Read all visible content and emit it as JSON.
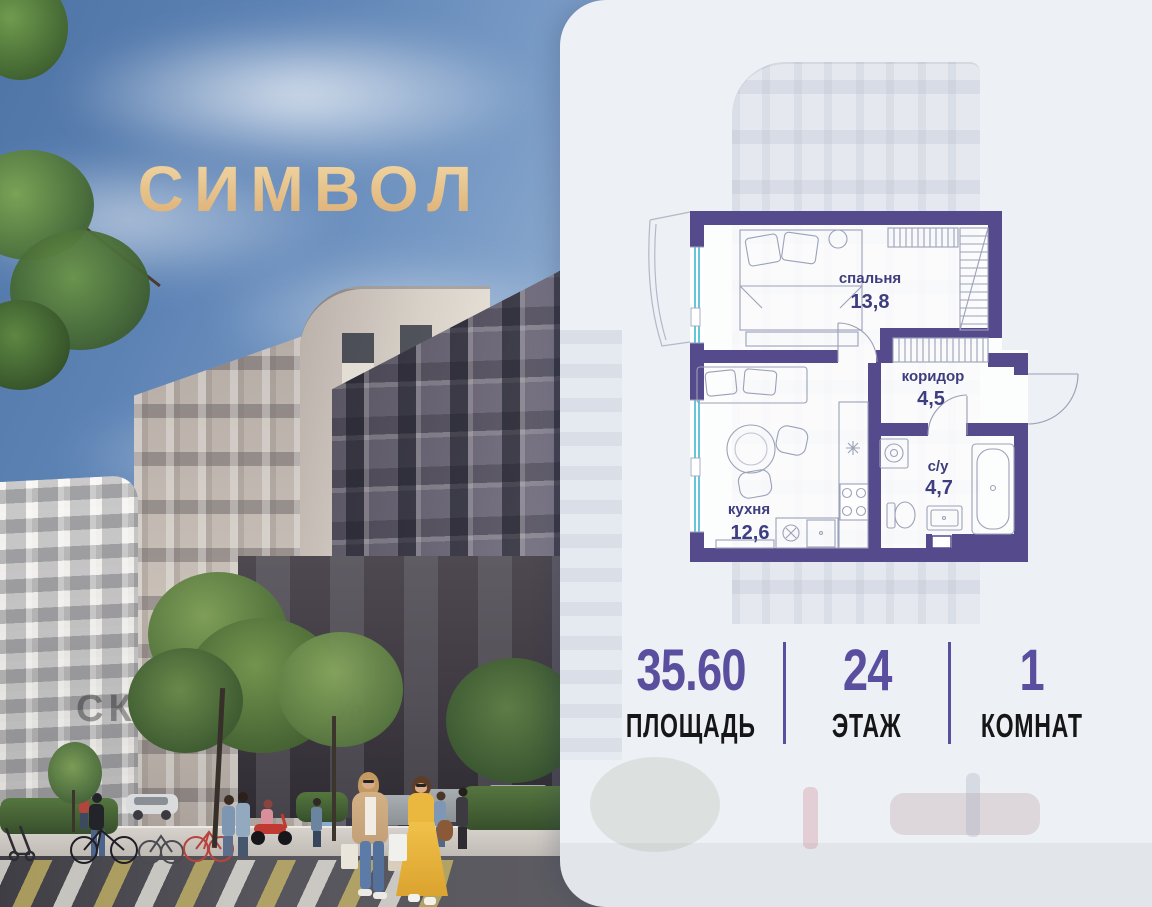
{
  "brand": {
    "logo_text": "СИМВОЛ",
    "logo_color": "#e5bf86"
  },
  "promo": {
    "watermark_text": "СКИДКА 12%"
  },
  "floorplan": {
    "rooms": [
      {
        "key": "bedroom",
        "name": "спальня",
        "area": "13,8"
      },
      {
        "key": "corridor",
        "name": "коридор",
        "area": "4,5"
      },
      {
        "key": "kitchen",
        "name": "кухня",
        "area": "12,6"
      },
      {
        "key": "bathroom",
        "name": "с/у",
        "area": "4,7"
      }
    ],
    "colors": {
      "wall": "#544a8c",
      "label": "#3d3d80",
      "window": "#66c5d9",
      "furniture": "#9ba1b8"
    }
  },
  "stats": {
    "items": [
      {
        "value": "35.60",
        "label": "ПЛОЩАДЬ"
      },
      {
        "value": "24",
        "label": "ЭТАЖ"
      },
      {
        "value": "1",
        "label": "КОМНАТ"
      }
    ],
    "value_color": "#5a4f9e",
    "label_color": "#161616",
    "divider_color": "#5a4f9e"
  }
}
